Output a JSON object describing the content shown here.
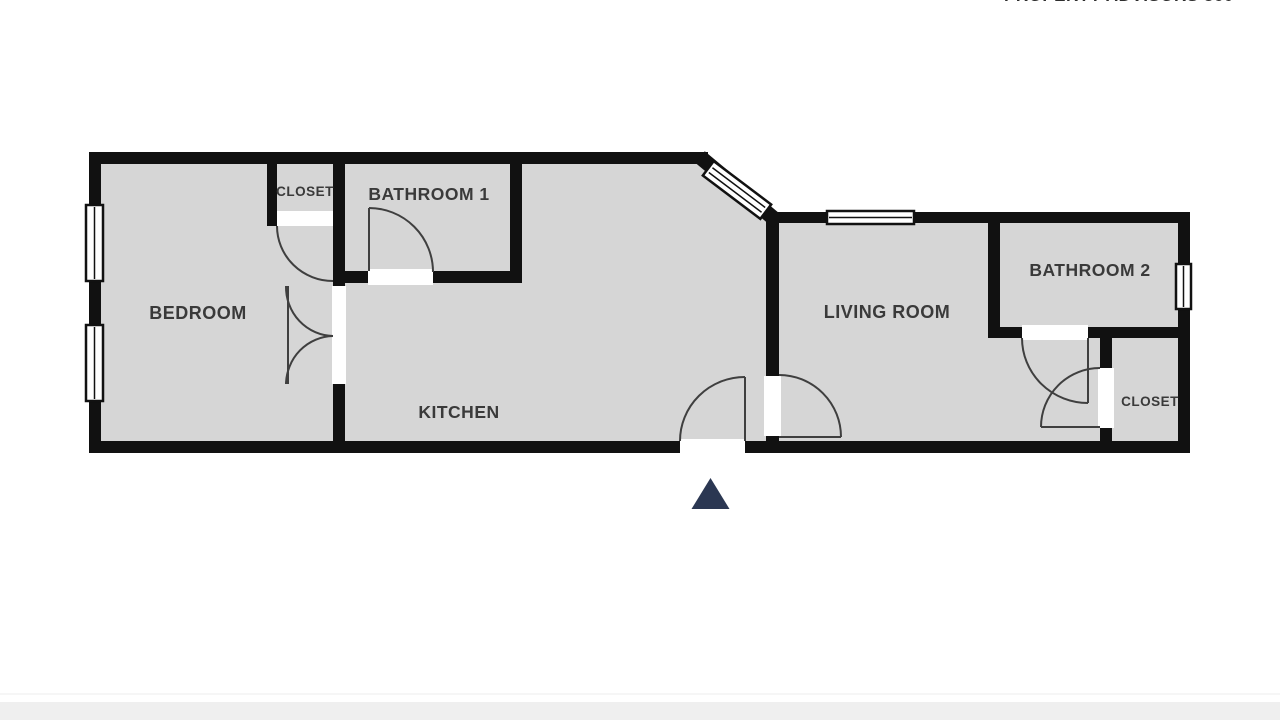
{
  "watermark": "PROPERTY ADVISORS 360",
  "rooms": {
    "bedroom": {
      "label": "BEDROOM"
    },
    "closet1": {
      "label": "CLOSET"
    },
    "bathroom1": {
      "label": "BATHROOM 1"
    },
    "kitchen": {
      "label": "KITCHEN"
    },
    "living": {
      "label": "LIVING ROOM"
    },
    "bathroom2": {
      "label": "BATHROOM 2"
    },
    "closet2": {
      "label": "CLOSET"
    }
  },
  "colors": {
    "room_fill": "#d6d6d6",
    "wall": "#111111",
    "door_arc": "#3f3f3f",
    "label_text": "#3a3a3a",
    "entrance_marker": "#2b3752",
    "footer_band": "#efefef",
    "window_fill": "#ffffff"
  },
  "markers": {
    "entrance": "triangle pointing up at main entry door"
  }
}
